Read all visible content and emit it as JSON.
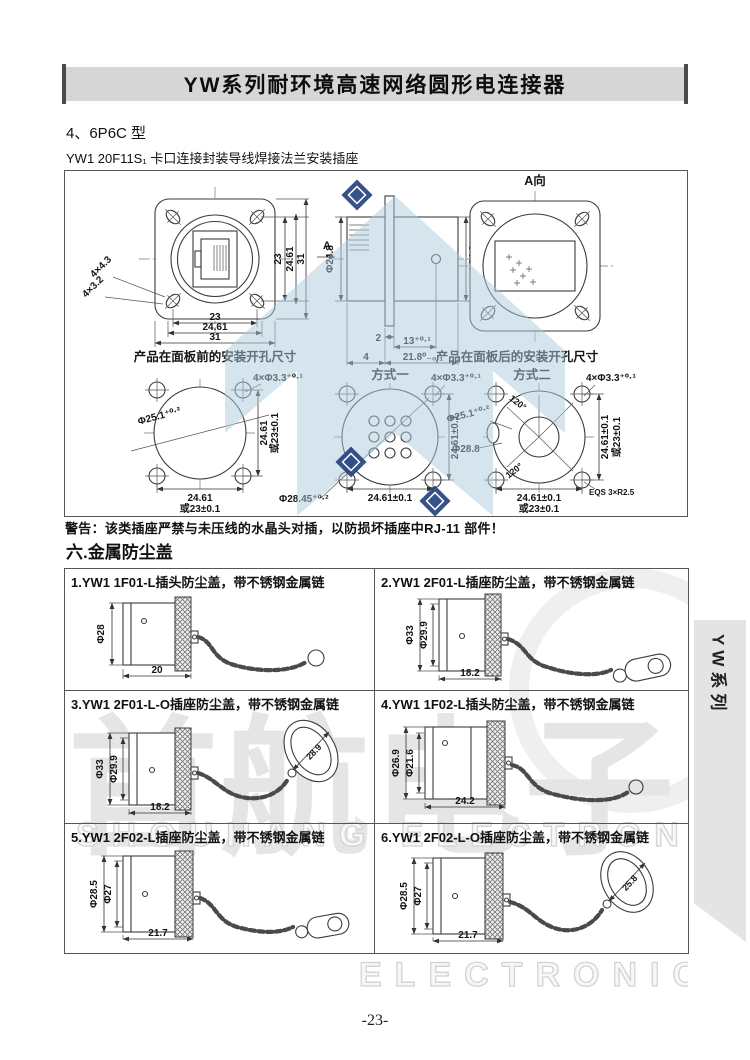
{
  "page": {
    "title": "YW系列耐环境高速网络圆形电连接器",
    "section4": "4、6P6C 型",
    "model": "YW1 20F11S₁ 卡口连接封装导线焊接法兰安装插座",
    "warning": "警告：该类插座严禁与未压线的水晶头对插，以防损坏插座中RJ-11 部件！",
    "section6": "六.金属防尘盖",
    "side_tab": "YW系列",
    "page_number": "-23-"
  },
  "colors": {
    "title_bar_gray": "#d6d6d6",
    "tab_gray": "#e4e4e4",
    "watermark_blue": "#aec9de",
    "logo_dark_blue": "#27437f"
  },
  "watermark": {
    "cn": "首航电子",
    "en1": "SHOUHANG ELECTRONICS",
    "en2": "ELECTRONICS"
  },
  "d1": {
    "view_a": "A向",
    "a": "A",
    "caption_front": "产品在面板前的安装开孔尺寸",
    "caption_rear": "产品在面板后的安装开孔尺寸",
    "front": {
      "slots1": "4×4.3",
      "slots2": "4×3.2",
      "b1": "23",
      "b2": "24.61",
      "b3": "31",
      "r1": "23",
      "r2": "24.61",
      "r3": "31"
    },
    "side": {
      "phiL": "Φ24.8",
      "phiR": "Φ24.8",
      "d2": "2",
      "d13": "13⁺⁰·¹",
      "d4": "4",
      "d218": "21.8⁰₋₀.₁"
    },
    "c1": {
      "holes": "4×Φ3.3⁺⁰·¹",
      "phi": "Φ25.1⁺⁰·²",
      "v1": "24.61",
      "v2": "或23±0.1",
      "h1": "24.61",
      "h2": "或23±0.1"
    },
    "c2": {
      "title": "方式一",
      "holes": "4×Φ3.3⁺⁰·¹",
      "phi": "Φ28.45⁺⁰·²",
      "v1": "24.61±0.1",
      "h1": "24.61±0.1"
    },
    "c3": {
      "title": "方式二",
      "holes": "4×Φ3.3⁺⁰·¹",
      "phi1": "Φ25.1⁺⁰·²",
      "phi2": "Φ28.8",
      "ang1": "120°",
      "ang2": "120°",
      "v1": "24.61±0.1",
      "v2": "或23±0.1",
      "h1": "24.61±0.1",
      "h2": "或23±0.1",
      "note": "EQS 3×R2.5"
    }
  },
  "caps": {
    "cells": [
      {
        "title": "1.YW1 1F01-L插头防尘盖，带不锈钢金属链",
        "phi1": "Φ28",
        "w": "20"
      },
      {
        "title": "2.YW1 2F01-L插座防尘盖，带不锈钢金属链",
        "phi1": "Φ33",
        "phi2": "Φ29.9",
        "w": "18.2"
      },
      {
        "title": "3.YW1 2F01-L-O插座防尘盖，带不锈钢金属链",
        "phi1": "Φ33",
        "phi2": "Φ29.9",
        "w": "18.2",
        "ring": "28.9"
      },
      {
        "title": "4.YW1 1F02-L插头防尘盖，带不锈钢金属链",
        "phi1": "Φ26.9",
        "phi2": "Φ21.6",
        "w": "24.2"
      },
      {
        "title": "5.YW1 2F02-L插座防尘盖，带不锈钢金属链",
        "phi1": "Φ28.5",
        "phi2": "Φ27",
        "w": "21.7"
      },
      {
        "title": "6.YW1 2F02-L-O插座防尘盖，带不锈钢金属链",
        "phi1": "Φ28.5",
        "phi2": "Φ27",
        "w": "21.7",
        "ring": "25.8"
      }
    ]
  }
}
